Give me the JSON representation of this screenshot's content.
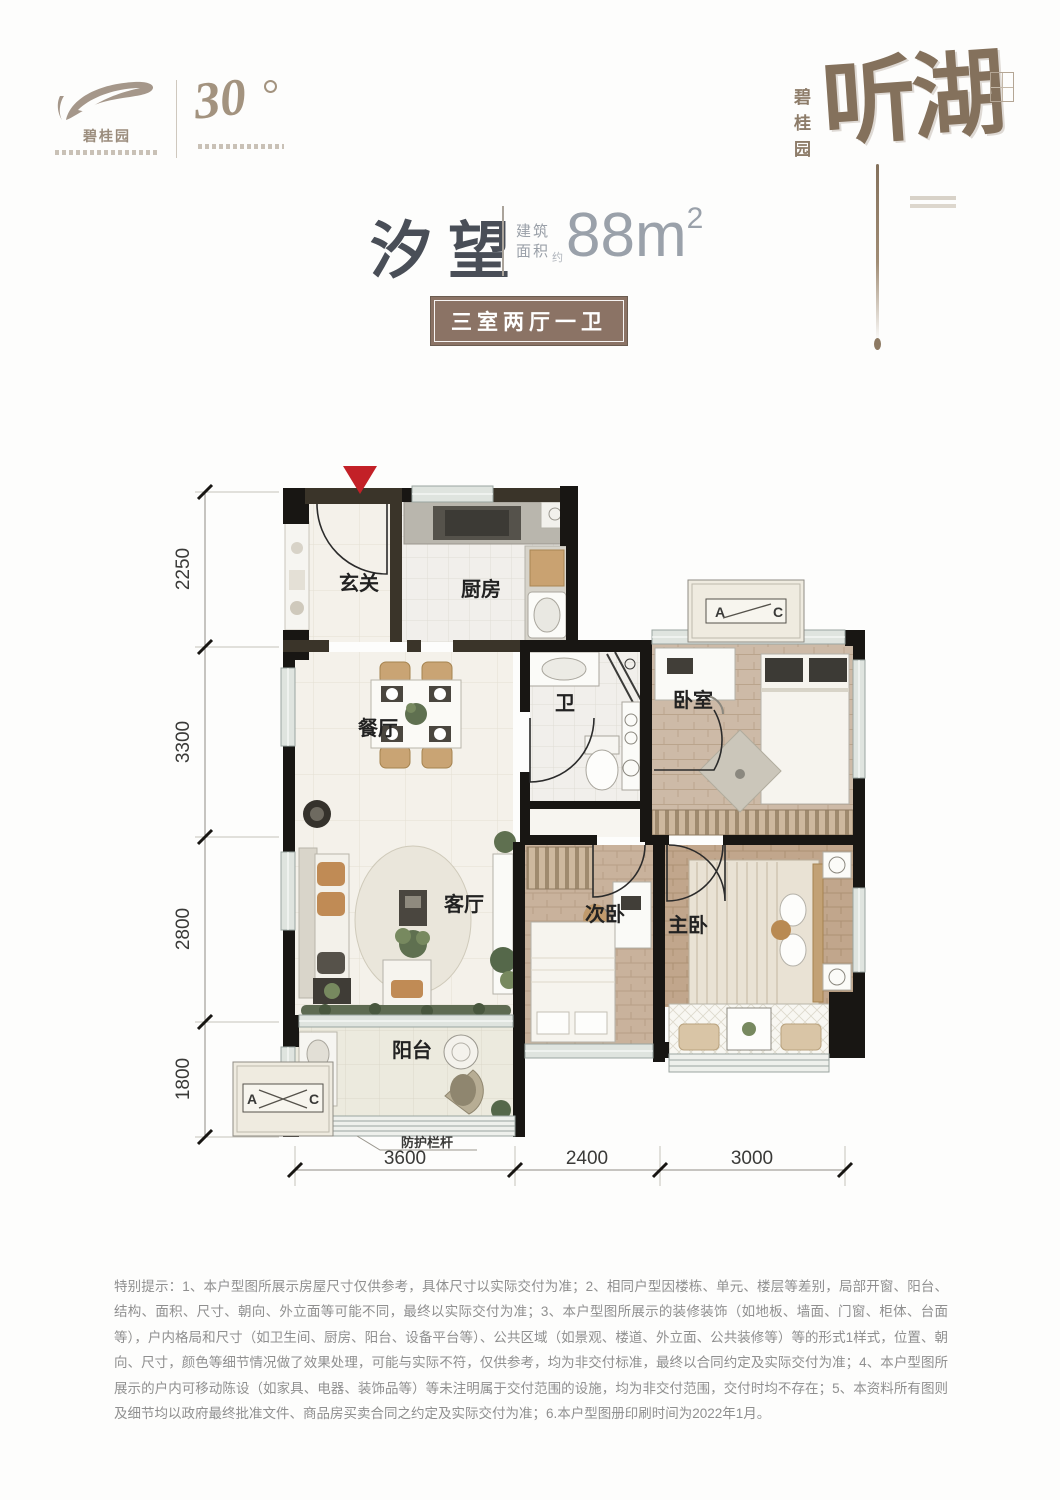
{
  "brand": {
    "left": {
      "name": "碧桂园",
      "mark": "30"
    },
    "right": {
      "vertical": "碧桂园",
      "calligraphy": "听湖"
    }
  },
  "title": {
    "name": "汐望",
    "area_label_1": "建筑",
    "area_label_2": "面积",
    "area_approx": "约",
    "area_value": "88m",
    "area_exp": "2"
  },
  "badge": {
    "label": "三室两厅一卫"
  },
  "plan": {
    "rooms": {
      "entry": {
        "label": "玄关"
      },
      "kitchen": {
        "label": "厨房"
      },
      "dining": {
        "label": "餐厅"
      },
      "bath": {
        "label": "卫"
      },
      "bedroom": {
        "label": "卧室"
      },
      "living": {
        "label": "客厅"
      },
      "second": {
        "label": "次卧"
      },
      "master": {
        "label": "主卧"
      },
      "balcony": {
        "label": "阳台"
      }
    },
    "ac": {
      "a": "A",
      "c": "C"
    },
    "railing_label": "防护栏杆",
    "dims_vertical": [
      "2250",
      "3300",
      "2800",
      "1800"
    ],
    "dims_horizontal": [
      "3600",
      "2400",
      "3000"
    ]
  },
  "colors": {
    "accent_red": "#c32027",
    "badge_brown": "#8b7365",
    "calligraphy_brown": "#84715c",
    "title_dark": "#494e57",
    "wall_black": "#181613"
  },
  "disclaimer": {
    "text": "特别提示：1、本户型图所展示房屋尺寸仅供参考，具体尺寸以实际交付为准；2、相同户型因楼栋、单元、楼层等差别，局部开窗、阳台、结构、面积、尺寸、朝向、外立面等可能不同，最终以实际交付为准；3、本户型图所展示的装修装饰（如地板、墙面、门窗、柜体、台面等），户内格局和尺寸（如卫生间、厨房、阳台、设备平台等）、公共区域（如景观、楼道、外立面、公共装修等）等的形式1样式，位置、朝向、尺寸，颜色等细节情况做了效果处理，可能与实际不符，仅供参考，均为非交付标准，最终以合同约定及实际交付为准；4、本户型图所展示的户内可移动陈设（如家具、电器、装饰品等）等未注明属于交付范围的设施，均为非交付范围，交付时均不存在；5、本资料所有图则及细节均以政府最终批准文件、商品房买卖合同之约定及实际交付为准；6.本户型图册印刷时间为2022年1月。"
  }
}
